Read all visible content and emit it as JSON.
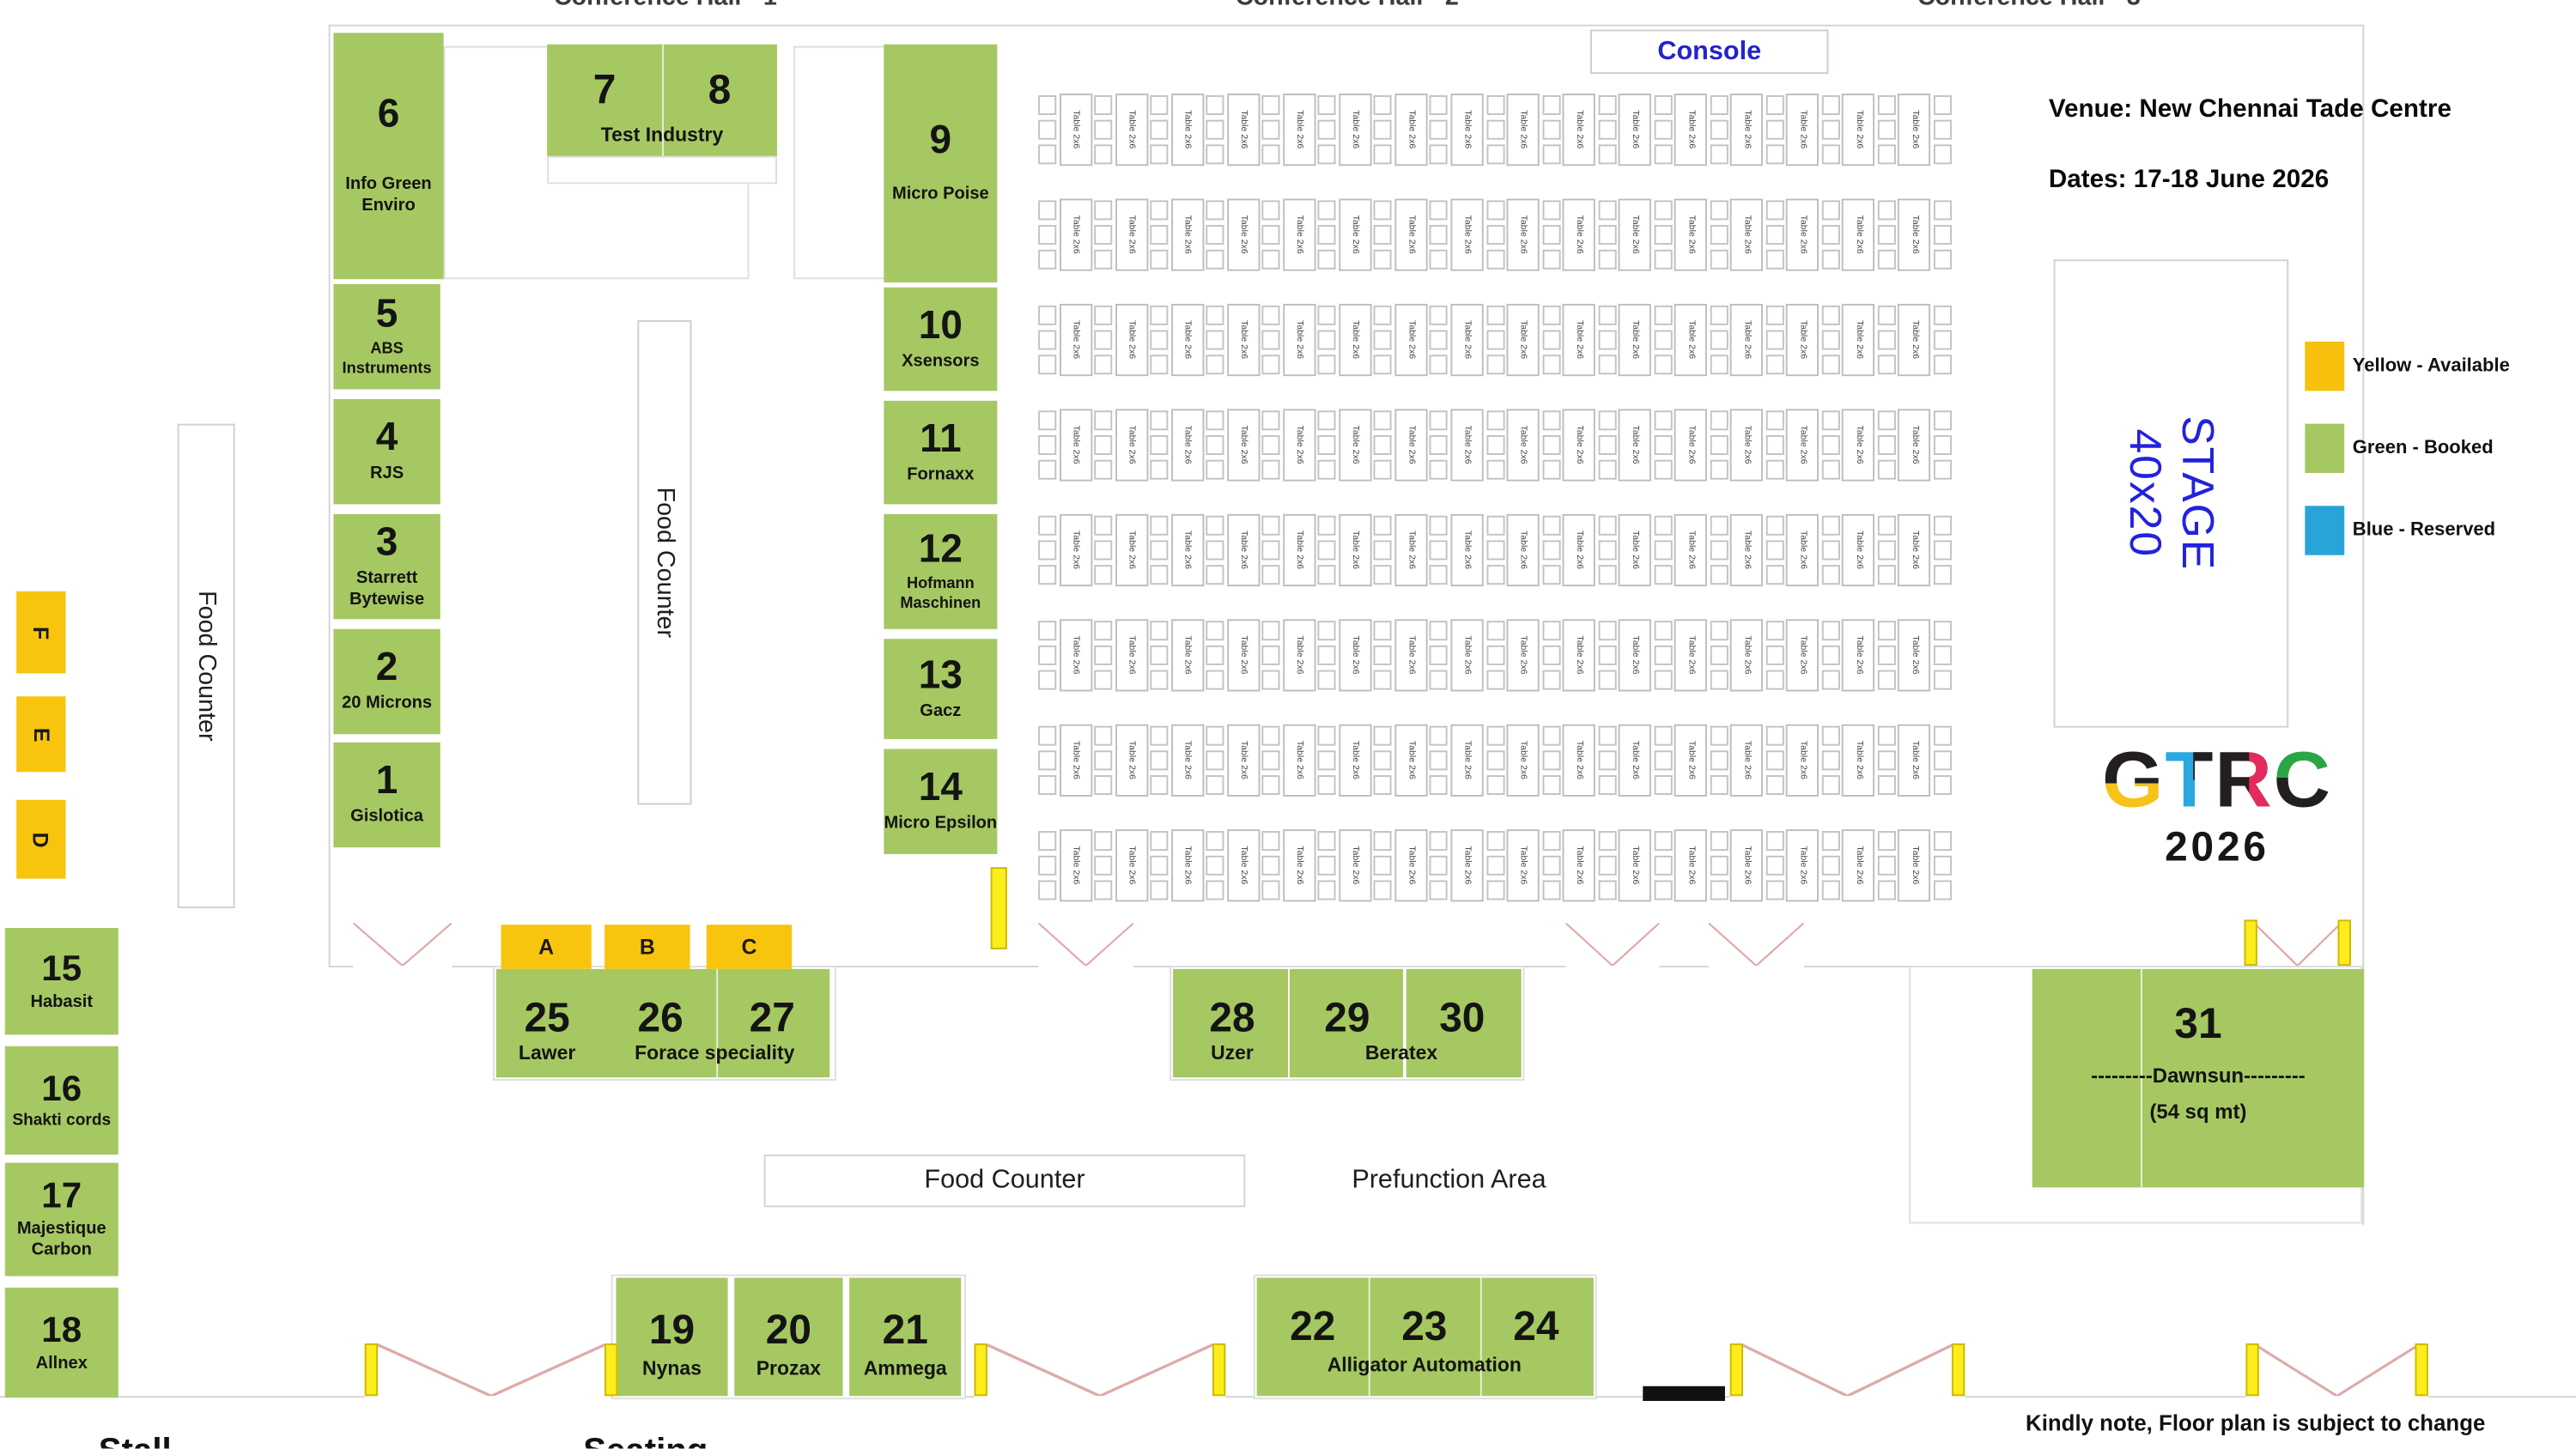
{
  "halls": {
    "h1": "Conference Hall - 1",
    "h2": "Conference Hall - 2",
    "h3": "Conference Hall - 3"
  },
  "header": {
    "console": "Console",
    "venue": "Venue: New Chennai Tade Centre",
    "dates": "Dates: 17-18 June 2026"
  },
  "stage": {
    "line1": "STAGE",
    "line2": "40x20"
  },
  "legend": [
    {
      "label": "Yellow - Available",
      "color": "#f6c00c"
    },
    {
      "label": "Green - Booked",
      "color": "#a6c862"
    },
    {
      "label": "Blue - Reserved",
      "color": "#29a4d9"
    }
  ],
  "logo": {
    "letters": [
      "G",
      "T",
      "R",
      "C"
    ],
    "year": "2026"
  },
  "areas": {
    "food_counter_left": "Food Counter",
    "food_counter_mid": "Food Counter",
    "food_counter_bottom": "Food Counter",
    "prefunction": "Prefunction Area"
  },
  "slots": {
    "F": "F",
    "E": "E",
    "D": "D",
    "A": "A",
    "B": "B",
    "C": "C"
  },
  "booths": {
    "b1": {
      "num": "1",
      "name": "Gislotica"
    },
    "b2": {
      "num": "2",
      "name": "20 Microns"
    },
    "b3": {
      "num": "3",
      "name": "Starrett Bytewise"
    },
    "b4": {
      "num": "4",
      "name": "RJS"
    },
    "b5": {
      "num": "5",
      "name": "ABS Instruments"
    },
    "b6": {
      "num": "6",
      "name": "Info Green Enviro"
    },
    "b7_8": {
      "num1": "7",
      "num2": "8",
      "name": "Test Industry"
    },
    "b9": {
      "num": "9",
      "name": "Micro Poise"
    },
    "b10": {
      "num": "10",
      "name": "Xsensors"
    },
    "b11": {
      "num": "11",
      "name": "Fornaxx"
    },
    "b12": {
      "num": "12",
      "name": "Hofmann Maschinen"
    },
    "b13": {
      "num": "13",
      "name": "Gacz"
    },
    "b14": {
      "num": "14",
      "name": "Micro Epsilon"
    },
    "b15": {
      "num": "15",
      "name": "Habasit"
    },
    "b16": {
      "num": "16",
      "name": "Shakti cords"
    },
    "b17": {
      "num": "17",
      "name": "Majestique Carbon"
    },
    "b18": {
      "num": "18",
      "name": "Allnex"
    },
    "b19": {
      "num": "19",
      "name": "Nynas"
    },
    "b20": {
      "num": "20",
      "name": "Prozax"
    },
    "b21": {
      "num": "21",
      "name": "Ammega"
    },
    "b22_24": {
      "num1": "22",
      "num2": "23",
      "num3": "24",
      "name": "Alligator Automation"
    },
    "b25": {
      "num": "25",
      "name": "Lawer"
    },
    "b26_27": {
      "num1": "26",
      "num2": "27",
      "name": "Forace speciality"
    },
    "b28": {
      "num": "28",
      "name": "Uzer"
    },
    "b29_30": {
      "num1": "29",
      "num2": "30",
      "name": "Beratex"
    },
    "b31": {
      "num": "31",
      "name": "---------Dawnsun---------",
      "size": "(54 sq mt)"
    }
  },
  "table_grid": {
    "label": "Table 2x6",
    "rows": 8,
    "cols": 16
  },
  "footer": {
    "note": "Kindly note, Floor plan is subject to change",
    "cut_left": "Stall",
    "cut_right": "Seating"
  }
}
